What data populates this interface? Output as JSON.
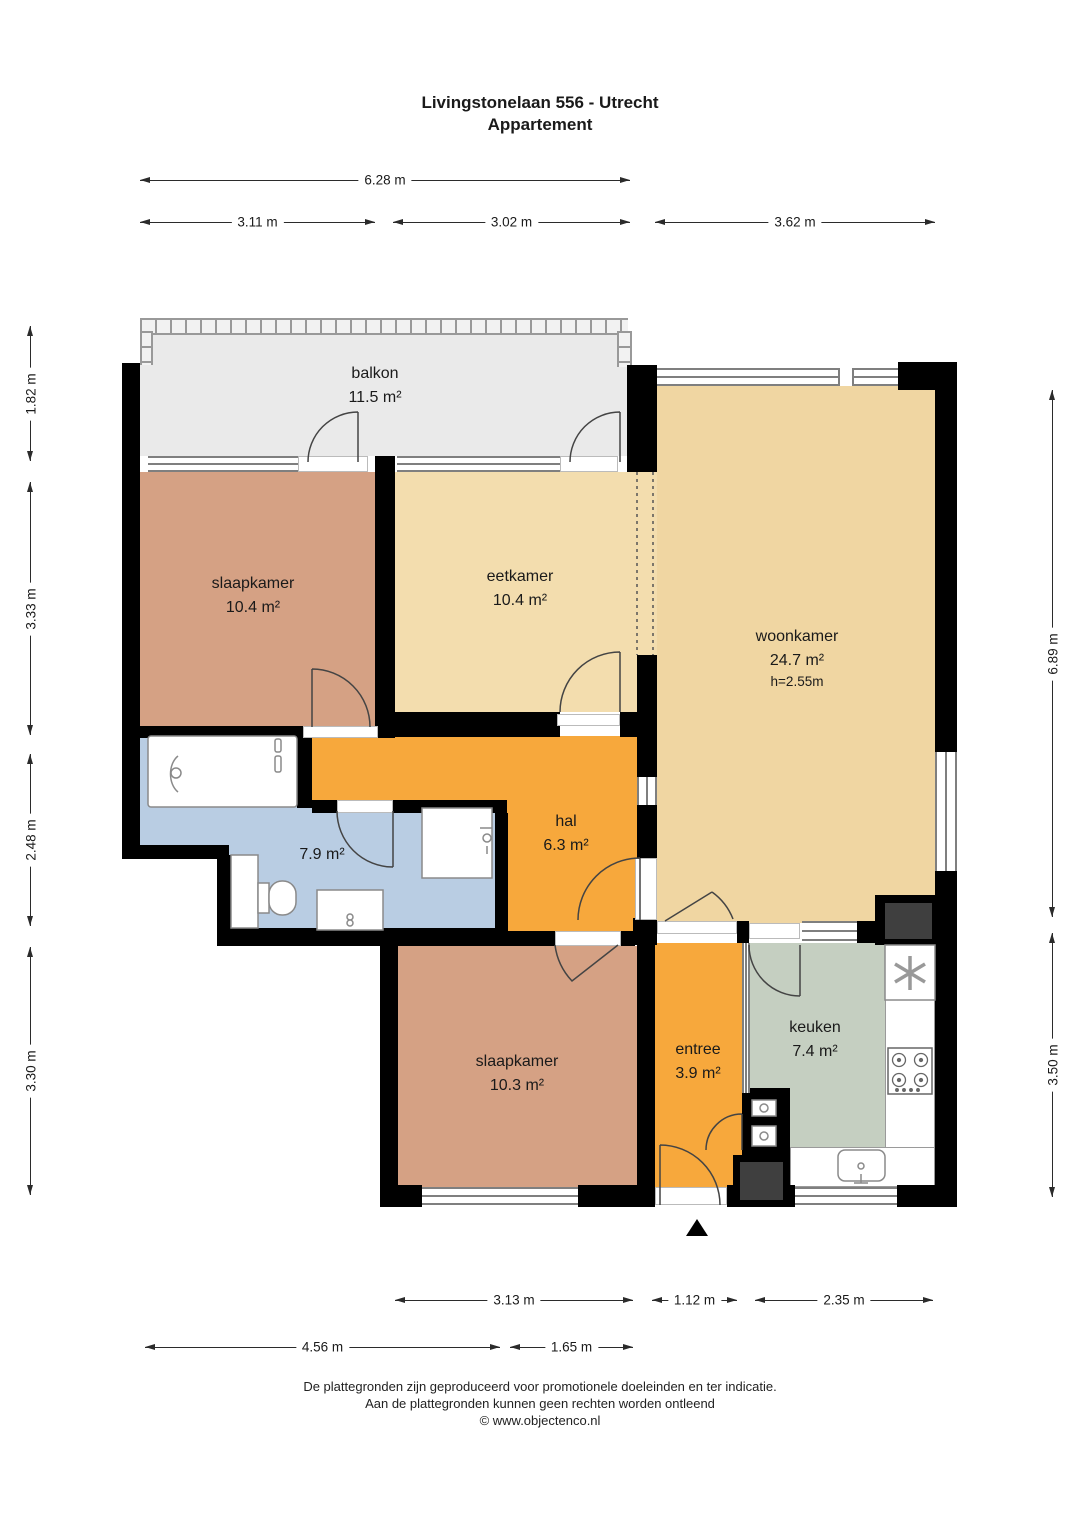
{
  "title": {
    "line1": "Livingstonelaan 556 - Utrecht",
    "line2": "Appartement"
  },
  "rooms": [
    {
      "name": "balkon",
      "area": "11.5 m²"
    },
    {
      "name": "slaapkamer",
      "area": "10.4 m²"
    },
    {
      "name": "eetkamer",
      "area": "10.4 m²"
    },
    {
      "name": "woonkamer",
      "area": "24.7 m²",
      "height_label": "h=2.55m"
    },
    {
      "name": "",
      "area": "7.9 m²"
    },
    {
      "name": "hal",
      "area": "6.3 m²"
    },
    {
      "name": "slaapkamer",
      "area": "10.3 m²"
    },
    {
      "name": "entree",
      "area": "3.9 m²"
    },
    {
      "name": "keuken",
      "area": "7.4 m²"
    }
  ],
  "dims": {
    "top": [
      "6.28 m",
      "3.11 m",
      "3.02 m",
      "3.62 m"
    ],
    "left": [
      "1.82 m",
      "3.33 m",
      "2.48 m",
      "3.30 m"
    ],
    "right": [
      "6.89 m",
      "3.50 m"
    ],
    "bottom": [
      "3.13 m",
      "1.12 m",
      "2.35 m",
      "4.56 m",
      "1.65 m"
    ]
  },
  "footer": {
    "line1": "De plattegronden zijn geproduceerd voor promotionele doeleinden en ter indicatie.",
    "line2": "Aan de plattegronden kunnen geen rechten worden ontleend",
    "line3": "© www.objectenco.nl"
  },
  "colors": {
    "walls": "#000000",
    "balkon": "#eaeaea",
    "slaapkamer": "#d5a184",
    "eetkamer": "#f3ddae",
    "woonkamer": "#f0d6a2",
    "hal": "#f7a83c",
    "badkamer": "#b9cde3",
    "keuken": "#c5cfc1",
    "cupboard": "#a78c62",
    "shaft": "#3f3f3f",
    "line": "#444444"
  }
}
